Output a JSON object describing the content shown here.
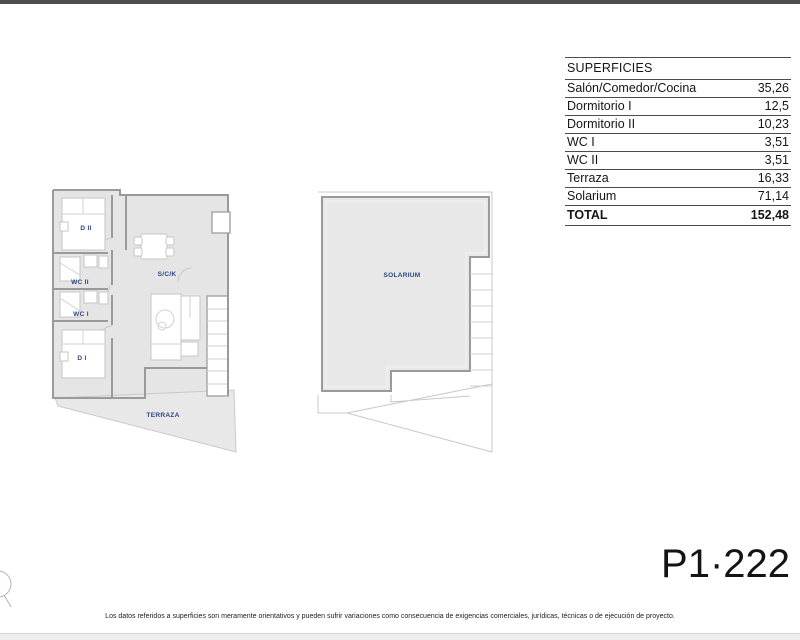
{
  "page": {
    "top_bar_color": "#4d4d4d",
    "background_color": "#ffffff",
    "footer_strip_color": "#ededed",
    "plan_fill_color": "#e5e5e5",
    "room_label_color": "#2c4585"
  },
  "table": {
    "header": "SUPERFICIES",
    "rows": [
      {
        "label": "Salón/Comedor/Cocina",
        "value": "35,26"
      },
      {
        "label": "Dormitorio I",
        "value": "12,5"
      },
      {
        "label": "Dormitorio II",
        "value": "10,23"
      },
      {
        "label": "WC I",
        "value": "3,51"
      },
      {
        "label": "WC II",
        "value": "3,51"
      },
      {
        "label": "Terraza",
        "value": "16,33"
      },
      {
        "label": "Solarium",
        "value": "71,14"
      }
    ],
    "total": {
      "label": "TOTAL",
      "value": "152,48"
    }
  },
  "plans": {
    "floor_plan": {
      "labels": {
        "d2": "D II",
        "wc2": "WC II",
        "wc1": "WC I",
        "d1": "D I",
        "sck": "S/C/K",
        "terraza": "TERRAZA"
      }
    },
    "solarium_plan": {
      "label": "SOLARIUM"
    }
  },
  "unit_code": "P1·222",
  "disclaimer": "Los datos referidos a superficies son meramente orientativos y pueden sufrir variaciones como consecuencia de exigencias comerciales, jurídicas, técnicas o de ejecución de proyecto."
}
